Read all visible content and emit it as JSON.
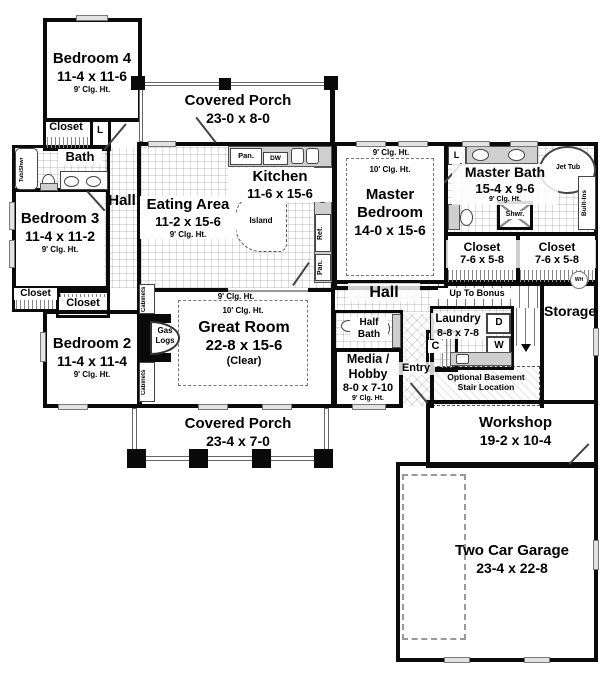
{
  "rooms": {
    "bedroom4": {
      "name": "Bedroom 4",
      "dims": "11-4 x 11-6",
      "ceiling": "9' Clg. Ht."
    },
    "closet_b4": {
      "label": "Closet"
    },
    "linen_b4": {
      "label": "L"
    },
    "bath": {
      "label": "Bath"
    },
    "tub_shwr": {
      "label": "Tub/Shwr"
    },
    "hall_left": {
      "label": "Hall"
    },
    "bedroom3": {
      "name": "Bedroom 3",
      "dims": "11-4 x 11-2",
      "ceiling": "9' Clg. Ht."
    },
    "closet_b3_left": {
      "label": "Closet"
    },
    "closet_b3_right": {
      "label": "Closet"
    },
    "bedroom2": {
      "name": "Bedroom 2",
      "dims": "11-4 x 11-4",
      "ceiling": "9' Clg. Ht."
    },
    "porch_top": {
      "name": "Covered Porch",
      "dims": "23-0 x 8-0"
    },
    "kitchen": {
      "name": "Kitchen",
      "dims": "11-6 x 15-6"
    },
    "eating": {
      "name": "Eating Area",
      "dims": "11-2 x 15-6",
      "ceiling": "9' Clg. Ht."
    },
    "master_bedroom": {
      "line1": "Master",
      "line2": "Bedroom",
      "dims": "14-0 x 15-6",
      "ceiling_outer": "9' Clg. Ht.",
      "ceiling_inner": "10' Clg. Ht."
    },
    "master_bath": {
      "name": "Master Bath",
      "dims": "15-4 x 9-6",
      "ceiling": "9' Clg. Ht."
    },
    "closet_master_left": {
      "name": "Closet",
      "dims": "7-6 x 5-8"
    },
    "closet_master_right": {
      "name": "Closet",
      "dims": "7-6 x 5-8"
    },
    "great_room": {
      "name": "Great Room",
      "dims": "22-8 x 15-6",
      "note": "(Clear)",
      "ceiling_outer": "9' Clg. Ht.",
      "ceiling_inner": "10' Clg. Ht."
    },
    "hall_center": {
      "label": "Hall"
    },
    "half_bath": {
      "line1": "Half",
      "line2": "Bath"
    },
    "media_hobby": {
      "line1": "Media /",
      "line2": "Hobby",
      "dims": "8-0 x 7-10",
      "ceiling": "9' Clg. Ht."
    },
    "entry": {
      "label": "Entry"
    },
    "bonus_stairs": {
      "label": "Up To Bonus"
    },
    "laundry": {
      "name": "Laundry",
      "dims": "8-8 x 7-8"
    },
    "storage": {
      "label": "Storage"
    },
    "opt_basement": {
      "line1": "Optional Basement",
      "line2": "Stair Location"
    },
    "workshop": {
      "name": "Workshop",
      "dims": "19-2 x 10-4"
    },
    "garage": {
      "name": "Two Car Garage",
      "dims": "23-4 x 22-8"
    },
    "porch_bottom": {
      "name": "Covered Porch",
      "dims": "23-4 x 7-0"
    }
  },
  "fixtures": {
    "pantry_top": "Pan.",
    "dishwasher": "DW",
    "island": "Island",
    "refrigerator": "Ref.",
    "pantry_side": "Pan.",
    "linen_master": "L",
    "jet_tub": "Jet Tub",
    "shower": "Shwr.",
    "built_ins": "Built-Ins",
    "cabinets_upper": "Cabinets",
    "cabinets_lower": "Cabinets",
    "gas_logs_line1": "Gas",
    "gas_logs_line2": "Logs",
    "dryer": "D",
    "washer": "W",
    "coat_closet": "C",
    "water_heater": "WH"
  },
  "colors": {
    "wall": "#0a0a0a",
    "tile_line": "#c0c0c0",
    "counter": "#cfcfcf",
    "dashed_line": "#777777"
  }
}
